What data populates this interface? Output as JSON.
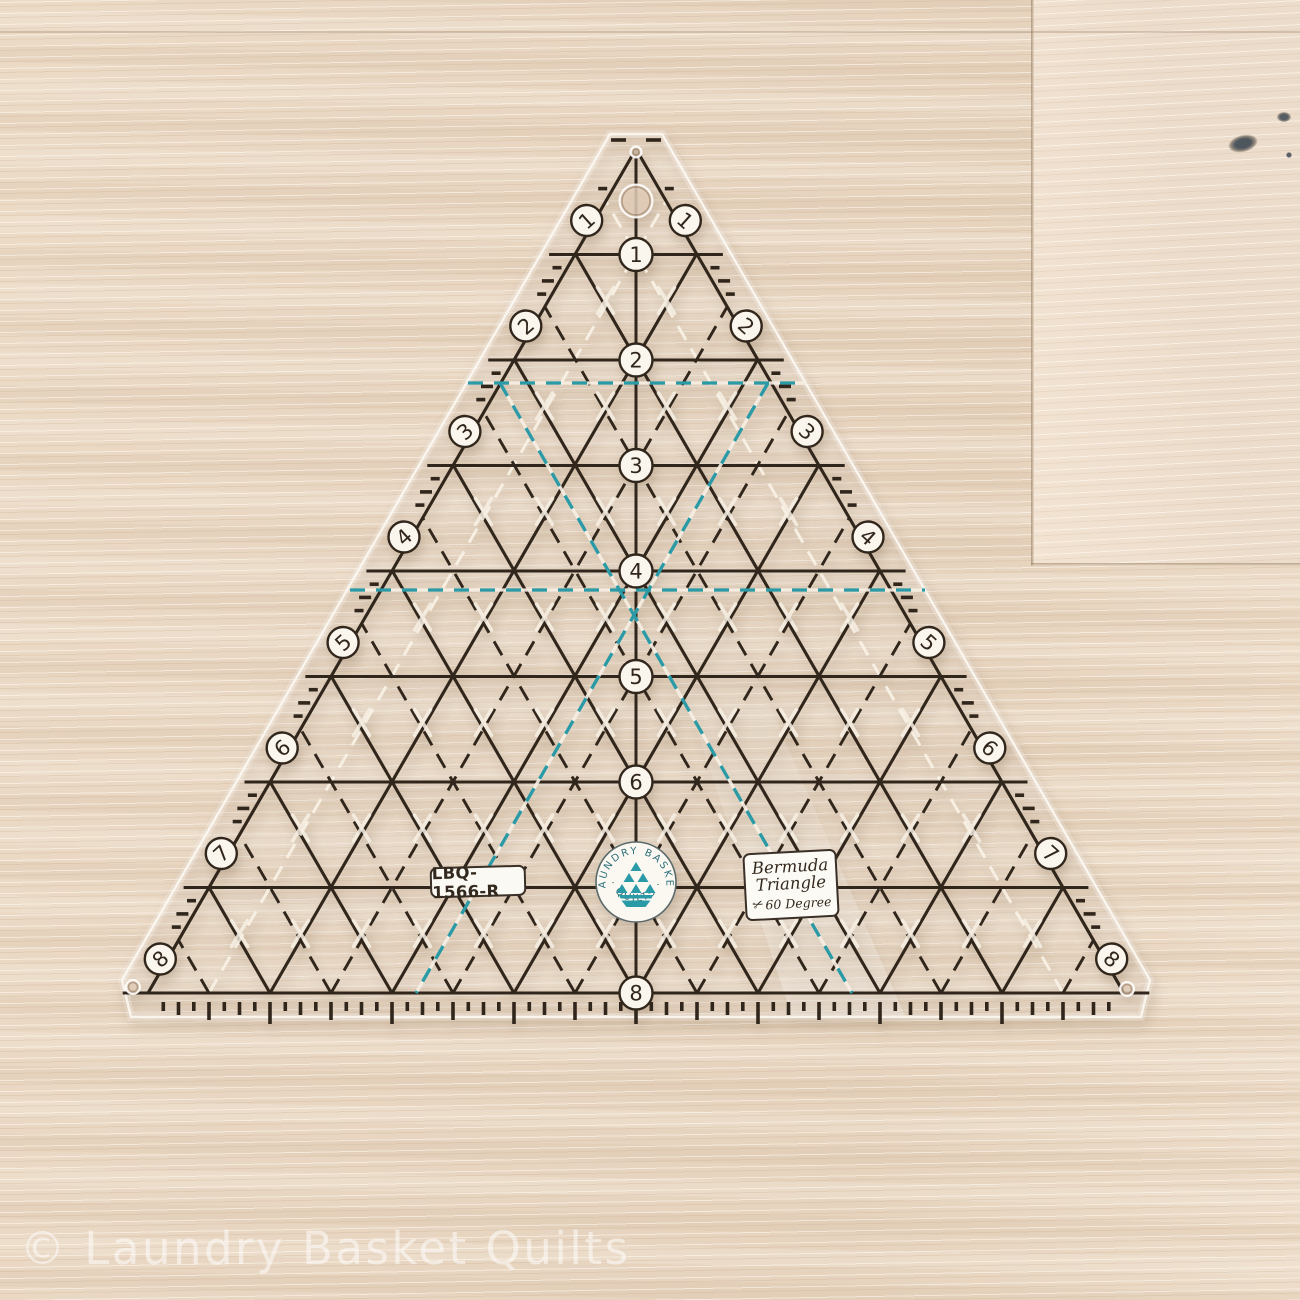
{
  "scene": {
    "watermark": "© Laundry Basket Quilts"
  },
  "wood": {
    "base_color": "#e8d6c2",
    "light_streak": "#f6ecdf",
    "dark_streak": "#d9c4ab",
    "seam_color": "#b59c80"
  },
  "ruler": {
    "sku": "LBQ-1566-R",
    "label": {
      "line1": "Bermuda",
      "line2": "Triangle",
      "line3": "60 Degree",
      "scissors_icon": "✂"
    },
    "logo": {
      "arc_top": "· LAUNDRY BASKET ·",
      "arc_bottom": "· QUILTS ·"
    },
    "numbers": {
      "center": [
        1,
        2,
        3,
        4,
        5,
        6,
        8
      ],
      "left_edge": [
        1,
        2,
        3,
        4,
        5,
        6,
        7,
        8
      ],
      "right_edge": [
        1,
        2,
        3,
        4,
        5,
        6,
        7,
        8
      ]
    },
    "colors": {
      "ink": "#31261b",
      "teal": "#2a9aa6",
      "white_mark": "#f7f0e4",
      "circle_fill": "#faf6ee"
    },
    "geometry": {
      "apex_x": 636,
      "apex_y": 149,
      "row_height": 105.5,
      "cell_side": 122,
      "base_y": 993,
      "rows": 8
    }
  }
}
